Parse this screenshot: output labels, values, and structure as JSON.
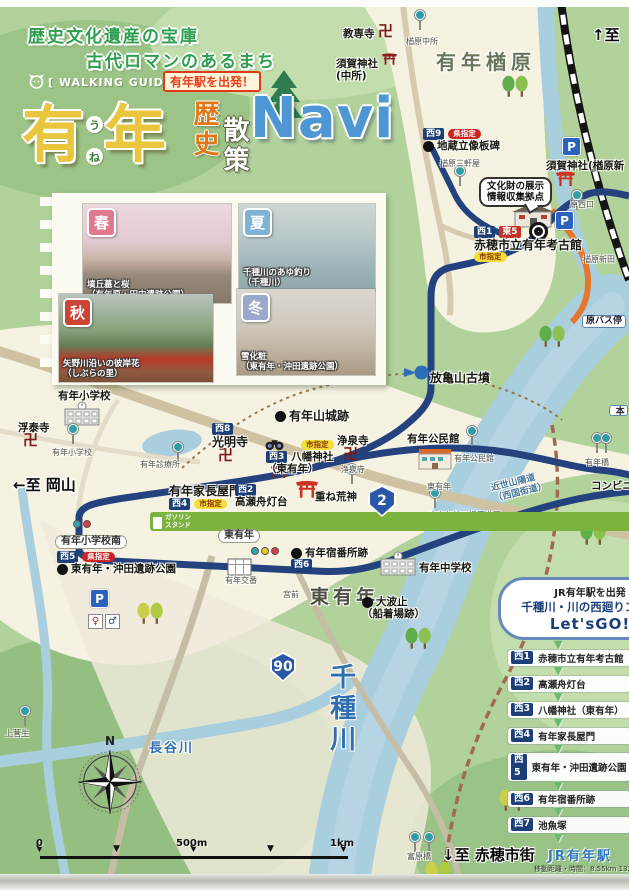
{
  "header": {
    "tagline1": "歴史文化遺産の宝庫",
    "tagline2": "古代ロマンのあるまち",
    "walking_guide": "[ WALKING GUIDE MAP ]",
    "depart_badge": "有年駅を出発！",
    "title": {
      "main1": "有",
      "furigana1": "う",
      "furigana2": "ね",
      "main2": "年",
      "sub1": "歴史",
      "sub2": "散策",
      "navi": "Navi"
    }
  },
  "photos": {
    "items": [
      {
        "season": "春",
        "color": "#e0798f",
        "captions": [
          "墳丘墓と桜",
          "（有年原・田中遺跡公園）"
        ]
      },
      {
        "season": "夏",
        "color": "#7fb3d6",
        "captions": [
          "千種川のあゆ釣り",
          "（千種川）"
        ]
      },
      {
        "season": "秋",
        "color": "#cc4433",
        "captions": [
          "矢野川沿いの彼岸花",
          "（しぶらの里）"
        ]
      },
      {
        "season": "冬",
        "color": "#9aa8cc",
        "captions": [
          "雪化粧",
          "（東有年・沖田遺跡公園）"
        ]
      }
    ]
  },
  "course": {
    "start_line": "JR有年駅を出発",
    "name": "千種川・川の西廻りコース",
    "go": "Let'sGO!",
    "items": [
      {
        "badge": "西1",
        "label": "赤穂市立有年考古館"
      },
      {
        "badge": "西2",
        "label": "高瀬舟灯台"
      },
      {
        "badge": "西3",
        "label": "八幡神社（東有年）"
      },
      {
        "badge": "西4",
        "label": "有年家長屋門"
      },
      {
        "badge": "西5",
        "label": "東有年・沖田遺跡公園"
      },
      {
        "badge": "西6",
        "label": "有年宿番所跡"
      },
      {
        "badge": "西7",
        "label": "池魚塚"
      }
    ],
    "end_station": "JR有年駅",
    "distance_note": "移動距離・時間：8.55km 132分"
  },
  "map": {
    "compass_n": "N",
    "scale": {
      "labels": [
        {
          "t": "0",
          "x": 36
        },
        {
          "t": "500m",
          "x": 176
        },
        {
          "t": "1km",
          "x": 330
        }
      ],
      "ticks_x": [
        40,
        117,
        194,
        271,
        344
      ]
    },
    "shields": [
      {
        "num": "2",
        "x": 367,
        "y": 485,
        "w": 30,
        "h": 32
      },
      {
        "num": "90",
        "x": 269,
        "y": 652,
        "w": 28,
        "h": 30
      }
    ],
    "labels": [
      {
        "n": "label-kyosenji",
        "x": 343,
        "y": 28,
        "cls": "poi",
        "tx": [
          "教専寺"
        ]
      },
      {
        "n": "label-narahara-chusho",
        "x": 406,
        "y": 37,
        "cls": "tiny",
        "tx": [
          "楢原中所"
        ]
      },
      {
        "n": "label-to-north",
        "x": 592,
        "y": 27,
        "cls": "dir",
        "tx": [
          "↑至"
        ]
      },
      {
        "n": "label-suga-jinja-chusho",
        "x": 336,
        "y": 58,
        "cls": "poi",
        "tx": [
          "須賀神社",
          "(中所)"
        ]
      },
      {
        "n": "label-une-narahara",
        "x": 436,
        "y": 51,
        "cls": "area",
        "tx": [
          "有年楢原"
        ]
      },
      {
        "n": "label-jizo-ryuzo-itabi",
        "x": 423,
        "y": 128,
        "cls": "poi",
        "dot": 1,
        "badgesTop": [
          [
            "西9",
            "navy"
          ],
          [
            "県指定",
            "ken"
          ]
        ],
        "tx": [
          "地蔵立像板碑"
        ]
      },
      {
        "n": "label-narahara-sangenya",
        "x": 440,
        "y": 159,
        "cls": "tiny",
        "tx": [
          "楢原三軒屋"
        ]
      },
      {
        "n": "label-suga-jinja-narahara",
        "x": 546,
        "y": 160,
        "cls": "poi",
        "tx": [
          "須賀神社(楢原新"
        ]
      },
      {
        "n": "label-hara-nishiguchi",
        "x": 570,
        "y": 200,
        "cls": "tiny",
        "tx": [
          "原西口"
        ]
      },
      {
        "n": "label-narahara-shinden",
        "x": 583,
        "y": 255,
        "cls": "tiny",
        "tx": [
          "楢原新田"
        ]
      },
      {
        "n": "bubble-bunkazai",
        "x": 479,
        "y": 177,
        "cls": "bubble",
        "tx": [
          "文化財の展示",
          "情報収集拠点"
        ]
      },
      {
        "n": "label-kokokan",
        "x": 474,
        "y": 226,
        "cls": "poi12",
        "badgesTop": [
          [
            "西1",
            "navy"
          ],
          [
            "東5",
            "red"
          ]
        ],
        "tx": [
          "赤穂市立有年考古館"
        ],
        "badgesBottom": [
          [
            "市指定",
            "shi"
          ]
        ]
      },
      {
        "n": "label-hara-busstop",
        "x": 582,
        "y": 315,
        "cls": "busbox",
        "tx": [
          "原バス停"
        ]
      },
      {
        "n": "label-partial-right",
        "x": 609,
        "y": 405,
        "cls": "busbox vert",
        "tx": [
          "本"
        ]
      },
      {
        "n": "label-une-elementary",
        "x": 58,
        "y": 390,
        "cls": "poi",
        "tx": [
          "有年小学校"
        ]
      },
      {
        "n": "label-fudaiji",
        "x": 18,
        "y": 422,
        "cls": "poi",
        "tx": [
          "浮泰寺"
        ]
      },
      {
        "n": "label-une-elementary-bus",
        "x": 52,
        "y": 448,
        "cls": "tiny",
        "tx": [
          "有年小学校"
        ]
      },
      {
        "n": "label-shinryojo",
        "x": 140,
        "y": 460,
        "cls": "tiny",
        "tx": [
          "有年診療所"
        ]
      },
      {
        "n": "label-to-okayama",
        "x": 13,
        "y": 477,
        "cls": "dir",
        "tx": [
          "←至 岡山"
        ]
      },
      {
        "n": "label-komyoji",
        "x": 212,
        "y": 423,
        "cls": "poi12",
        "badgesTop": [
          [
            "西8",
            "navy"
          ]
        ],
        "tx": [
          "光明寺"
        ]
      },
      {
        "n": "label-uneyama-castle",
        "x": 275,
        "y": 409,
        "cls": "poi12",
        "dot": 1,
        "tx": [
          "有年山城跡"
        ]
      },
      {
        "n": "label-hokiyama-kofun",
        "x": 430,
        "y": 371,
        "cls": "poi12",
        "tx": [
          "放亀山古墳"
        ]
      },
      {
        "n": "label-shi-shitei-hachiman",
        "x": 301,
        "y": 440,
        "badgesTop": [
          [
            "市指定",
            "shi"
          ]
        ],
        "tx": []
      },
      {
        "n": "label-hachiman-jinja",
        "x": 266,
        "y": 451,
        "cls": "poi",
        "lead": [
          [
            "西3",
            "navy"
          ]
        ],
        "tx": [
          "八幡神社",
          "（東有年）"
        ]
      },
      {
        "n": "label-josenji",
        "x": 337,
        "y": 435,
        "cls": "poi",
        "tx": [
          "浄泉寺"
        ]
      },
      {
        "n": "label-josenji-bus",
        "x": 341,
        "y": 465,
        "cls": "tiny",
        "tx": [
          "浄泉寺"
        ]
      },
      {
        "n": "label-kominkan",
        "x": 407,
        "y": 433,
        "cls": "poi",
        "tx": [
          "有年公民館"
        ]
      },
      {
        "n": "label-kominkan-bus",
        "x": 454,
        "y": 454,
        "cls": "tiny",
        "tx": [
          "有年公民館"
        ]
      },
      {
        "n": "label-kasane-kojin",
        "x": 315,
        "y": 491,
        "cls": "poi",
        "tx": [
          "重ね荒神"
        ]
      },
      {
        "n": "label-nagayamon",
        "x": 169,
        "y": 484,
        "cls": "poi12",
        "tx": [
          "有年家長屋門"
        ],
        "badgesBottom": [
          [
            "西4",
            "navy"
          ],
          [
            "市指定",
            "shi"
          ]
        ]
      },
      {
        "n": "label-takasebune",
        "x": 235,
        "y": 484,
        "cls": "poi",
        "badgesTop": [
          [
            "西2",
            "navy"
          ]
        ],
        "tx": [
          "高瀬舟灯台"
        ]
      },
      {
        "n": "label-higashiune-bus",
        "x": 427,
        "y": 482,
        "cls": "tiny",
        "tx": [
          "東有年"
        ]
      },
      {
        "n": "label-kinsei-sanyodo",
        "x": 492,
        "y": 477,
        "cls": "blue9",
        "rot": -14,
        "tx": [
          "近世山陽道",
          "（西国街道）"
        ]
      },
      {
        "n": "label-jido-yuen",
        "x": 429,
        "y": 511,
        "cls": "tiny",
        "tx": [
          "東有年第二児童遊園"
        ]
      },
      {
        "n": "label-unebashi",
        "x": 585,
        "y": 458,
        "cls": "tiny",
        "tx": [
          "有年橋"
        ]
      },
      {
        "n": "label-conbini",
        "x": 591,
        "y": 480,
        "cls": "poi",
        "tx": [
          "コンビニエ"
        ]
      },
      {
        "n": "label-gas-station",
        "x": 150,
        "y": 512,
        "cls": "gasbox",
        "tx": [
          "ガソリン",
          "スタンド"
        ]
      },
      {
        "n": "label-une-sho-minami",
        "x": 55,
        "y": 535,
        "cls": "xbox",
        "tx": [
          "有年小学校南"
        ]
      },
      {
        "n": "label-higashiune-crossing",
        "x": 218,
        "y": 529,
        "cls": "xbox",
        "tx": [
          "東有年"
        ]
      },
      {
        "n": "label-okita-park",
        "x": 57,
        "y": 551,
        "cls": "poi",
        "dot": 1,
        "badgesTop": [
          [
            "西5",
            "navy"
          ],
          [
            "県指定",
            "ken"
          ]
        ],
        "tx": [
          "東有年・沖田遺跡公園"
        ]
      },
      {
        "n": "label-koban",
        "x": 225,
        "y": 576,
        "cls": "tiny",
        "tx": [
          "有年交番"
        ]
      },
      {
        "n": "label-shukubansho",
        "x": 291,
        "y": 547,
        "cls": "poi",
        "dot": 1,
        "tx": [
          "有年宿番所跡"
        ],
        "badgesBottom": [
          [
            "西6",
            "navy"
          ]
        ]
      },
      {
        "n": "label-higashiune-area",
        "x": 310,
        "y": 586,
        "cls": "area2",
        "tx": [
          "東有年"
        ]
      },
      {
        "n": "label-miyamae",
        "x": 283,
        "y": 590,
        "cls": "tiny",
        "tx": [
          "宮前"
        ]
      },
      {
        "n": "label-onamidomari",
        "x": 362,
        "y": 596,
        "cls": "poi",
        "dot": 1,
        "tx": [
          "大波止",
          "（船着場跡）"
        ]
      },
      {
        "n": "label-une-junior-high",
        "x": 419,
        "y": 562,
        "cls": "poi",
        "tx": [
          "有年中学校"
        ]
      },
      {
        "n": "label-kamisugao",
        "x": 5,
        "y": 729,
        "cls": "tiny",
        "tx": [
          "上菅生"
        ]
      },
      {
        "n": "label-chikusagawa",
        "x": 325,
        "y": 663,
        "cls": "rivbig",
        "tx": [
          "千種川"
        ]
      },
      {
        "n": "label-hasegawa",
        "x": 149,
        "y": 741,
        "cls": "rivmid",
        "tx": [
          "長谷川"
        ]
      },
      {
        "n": "label-tomihara-bashi",
        "x": 407,
        "y": 852,
        "cls": "tiny",
        "tx": [
          "富原橋"
        ]
      },
      {
        "n": "label-to-ako",
        "x": 442,
        "y": 847,
        "cls": "dir",
        "tx": [
          "↓至 赤穂市街"
        ]
      }
    ],
    "icons": [
      {
        "t": "manji",
        "n": "manji-icon",
        "x": 378,
        "y": 24
      },
      {
        "t": "manji",
        "n": "manji-icon",
        "x": 23,
        "y": 433
      },
      {
        "t": "manji",
        "n": "manji-icon",
        "x": 218,
        "y": 448
      },
      {
        "t": "manji",
        "n": "manji-icon",
        "x": 343,
        "y": 447
      },
      {
        "t": "torii",
        "n": "torii-icon",
        "x": 382,
        "y": 52,
        "c": "#8b2020",
        "s": 15
      },
      {
        "t": "torii",
        "n": "torii-icon",
        "x": 556,
        "y": 170,
        "c": "#cc3322",
        "s": 19
      },
      {
        "t": "torii",
        "n": "torii-icon",
        "x": 271,
        "y": 464,
        "c": "#8b2020",
        "s": 17
      },
      {
        "t": "torii",
        "n": "torii-icon",
        "x": 296,
        "y": 479,
        "c": "#cc3322",
        "s": 22
      },
      {
        "t": "park",
        "n": "parking-icon",
        "x": 562,
        "y": 137
      },
      {
        "t": "park",
        "n": "parking-icon",
        "x": 555,
        "y": 211
      },
      {
        "t": "park",
        "n": "parking-icon",
        "x": 90,
        "y": 589
      },
      {
        "t": "school",
        "n": "school-icon",
        "x": 63,
        "y": 401
      },
      {
        "t": "school",
        "n": "school-icon",
        "x": 379,
        "y": 551
      },
      {
        "t": "bld",
        "n": "community-hall-icon",
        "x": 418,
        "y": 448
      },
      {
        "t": "museum",
        "n": "museum-icon",
        "x": 512,
        "y": 201
      },
      {
        "t": "koban",
        "n": "police-box-icon",
        "x": 227,
        "y": 558
      },
      {
        "t": "ring",
        "n": "museum-mark-icon",
        "x": 529,
        "y": 222
      },
      {
        "t": "bus",
        "n": "bus-stop-icon",
        "x": 415,
        "y": 10
      },
      {
        "t": "bus",
        "n": "bus-stop-icon",
        "x": 455,
        "y": 166
      },
      {
        "t": "bus",
        "n": "bus-stop-icon",
        "x": 572,
        "y": 190
      },
      {
        "t": "bus",
        "n": "bus-stop-icon",
        "x": 68,
        "y": 424
      },
      {
        "t": "bus",
        "n": "bus-stop-icon",
        "x": 173,
        "y": 442
      },
      {
        "t": "bus",
        "n": "bus-stop-icon",
        "x": 347,
        "y": 464
      },
      {
        "t": "bus",
        "n": "bus-stop-icon",
        "x": 467,
        "y": 426
      },
      {
        "t": "bus",
        "n": "bus-stop-icon",
        "x": 592,
        "y": 433
      },
      {
        "t": "bus",
        "n": "bus-stop-icon",
        "x": 601,
        "y": 433
      },
      {
        "t": "bus",
        "n": "bus-stop-icon",
        "x": 430,
        "y": 488
      },
      {
        "t": "bus",
        "n": "bus-stop-icon",
        "x": 20,
        "y": 706
      },
      {
        "t": "bus",
        "n": "bus-stop-icon",
        "x": 410,
        "y": 832
      },
      {
        "t": "bus",
        "n": "bus-stop-icon",
        "x": 424,
        "y": 832
      },
      {
        "t": "sig3",
        "n": "traffic-signal-icon",
        "x": 251,
        "y": 547
      },
      {
        "t": "sig2",
        "n": "traffic-signal-icon",
        "x": 73,
        "y": 520
      },
      {
        "t": "kofun",
        "n": "kofun-icon",
        "x": 403,
        "y": 365
      },
      {
        "t": "binoc",
        "n": "binoculars-icon",
        "x": 265,
        "y": 437
      },
      {
        "t": "tree2g",
        "n": "trees-icon",
        "x": 502,
        "y": 74
      },
      {
        "t": "tree2g",
        "n": "trees-icon",
        "x": 539,
        "y": 324
      },
      {
        "t": "tree2g",
        "n": "trees-icon",
        "x": 580,
        "y": 522
      },
      {
        "t": "tree2g",
        "n": "trees-icon",
        "x": 405,
        "y": 626
      },
      {
        "t": "tree2y",
        "n": "trees-icon",
        "x": 137,
        "y": 601
      },
      {
        "t": "tree2y",
        "n": "trees-icon",
        "x": 499,
        "y": 788
      },
      {
        "t": "tree2y",
        "n": "trees-icon",
        "x": 425,
        "y": 860
      },
      {
        "t": "pine",
        "n": "pine-tree-icon",
        "x": 266,
        "y": 70
      },
      {
        "t": "wc",
        "n": "toilet-icon",
        "x": 88,
        "y": 614
      }
    ]
  }
}
